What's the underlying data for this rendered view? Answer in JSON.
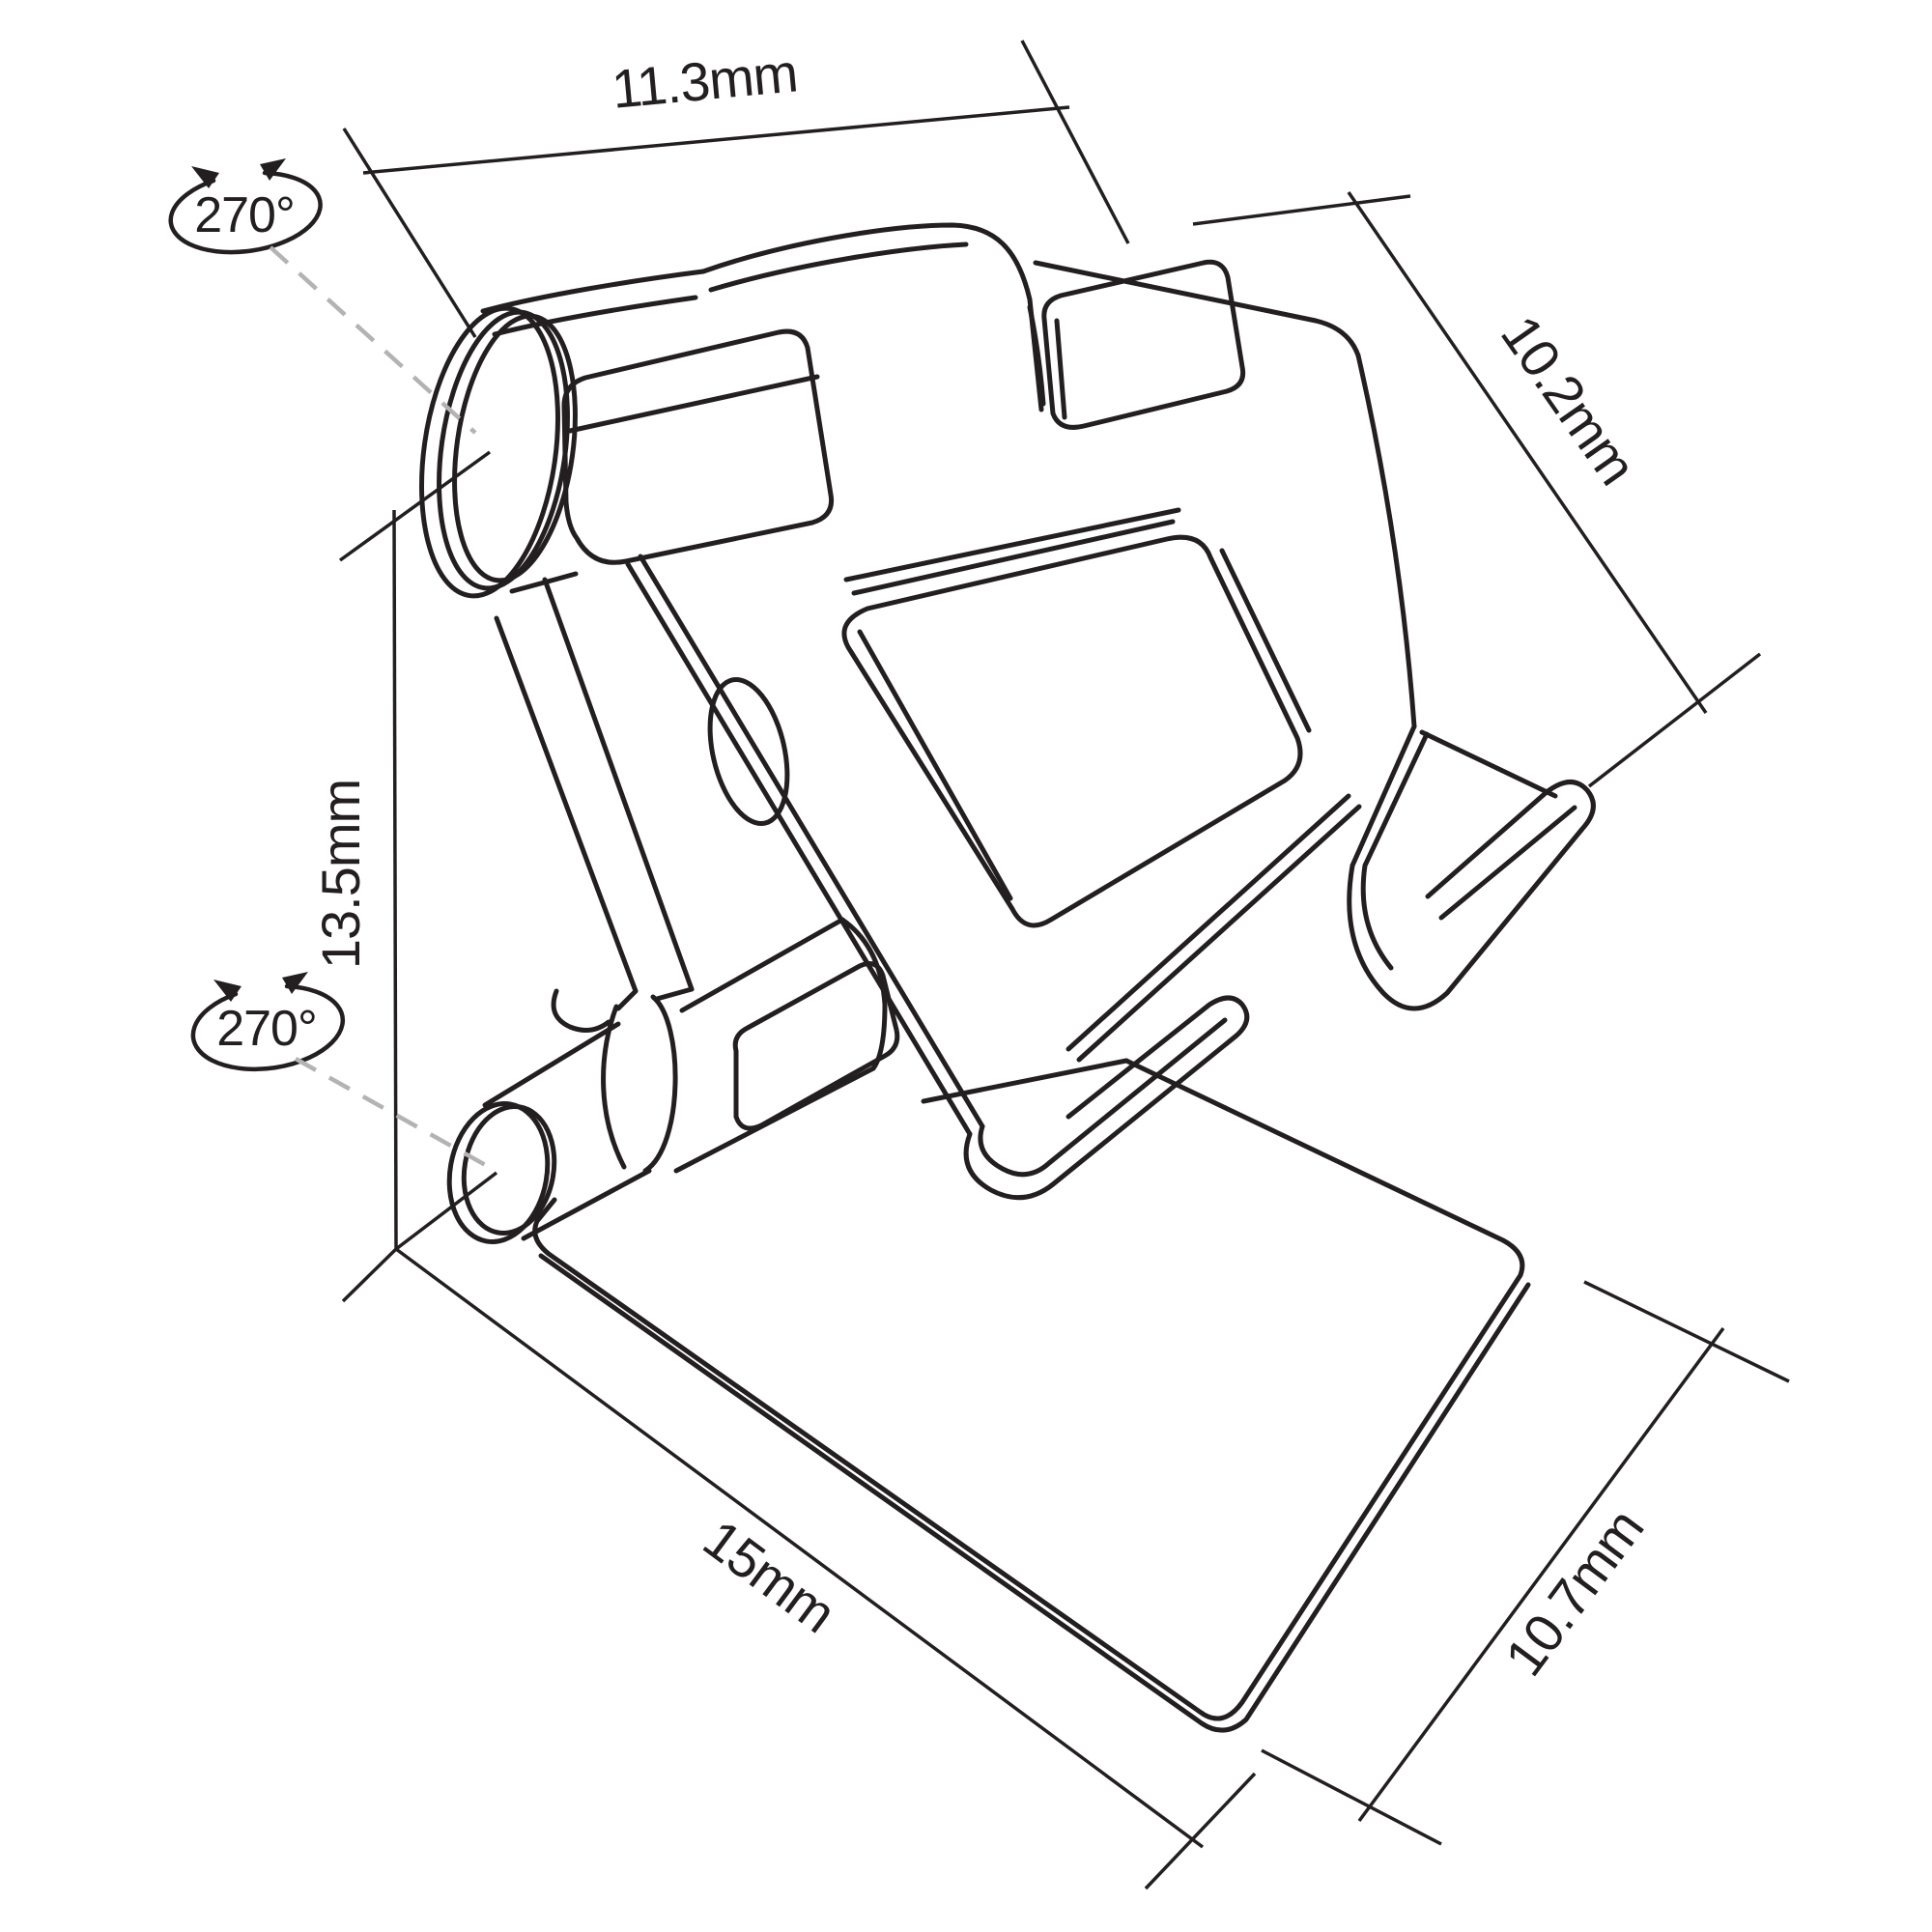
{
  "diagram": {
    "type": "technical-dimension-drawing",
    "subject": "foldable phone and tablet stand, isometric line art",
    "background_color": "#ffffff",
    "line_color": "#231f20",
    "leader_dash_color": "#b3b3b3"
  },
  "dimensions": {
    "top_width": {
      "label": "11.3mm"
    },
    "upper_depth": {
      "label": "10.2mm"
    },
    "height": {
      "label": "13.5mm"
    },
    "base_length": {
      "label": "15mm"
    },
    "base_depth": {
      "label": "10.7mm"
    }
  },
  "rotations": {
    "top_hinge": {
      "label": "270°"
    },
    "bottom_hinge": {
      "label": "270°"
    }
  }
}
